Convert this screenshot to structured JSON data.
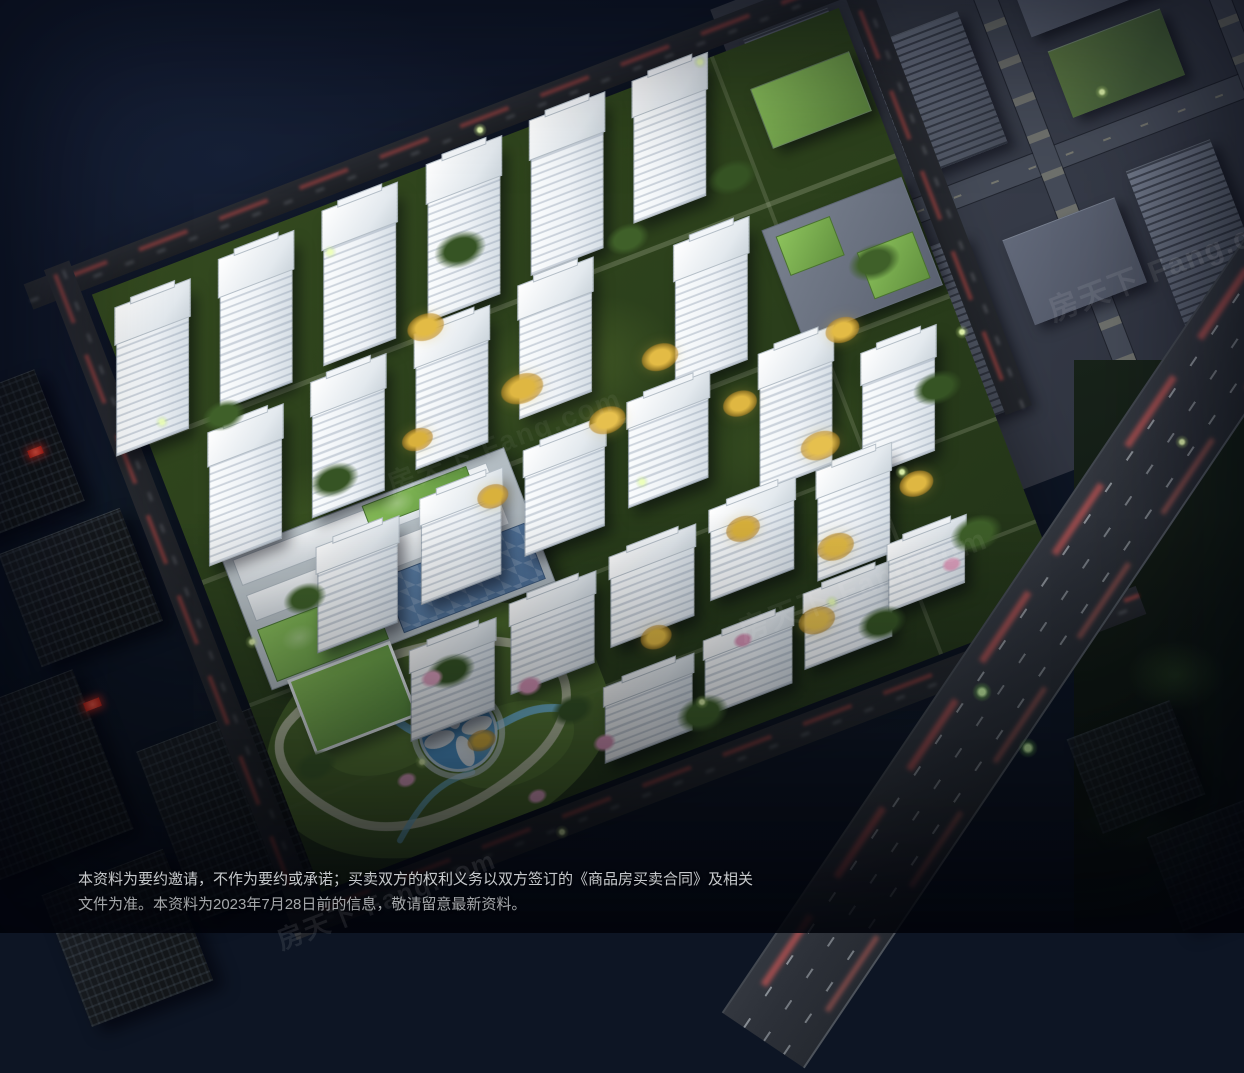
{
  "scene": {
    "description": "住宅小区整体鸟瞰夜景效果图（residential development aerial night rendering）",
    "elements": {
      "residential_towers": "white lit high-rise and mid-rise residential slabs in rows",
      "park": "central landscaped park with winding stream and circular plaza",
      "school": "school block with green roofs and blue playground",
      "commercial": "green-roof commercial podium blocks",
      "roads": "perimeter roads and elevated highway with red tail-light trails",
      "surroundings": "grey city blocks (top right), dark towers (bottom left), water (top left)"
    }
  },
  "colors": {
    "sky": "#0d1524",
    "water": "#10182a",
    "site-green": "#2a3e1b",
    "lawn": "#5d7c35",
    "road": "#26292e",
    "tower-face": "#eef2f6",
    "tree-yellow": "#e3bb45",
    "tree-green": "#3f6029",
    "tree-pink": "#e0a2c0",
    "stream-blue": "#74bede",
    "plaza-blue": "#4e96cc",
    "path-cream": "#cfd2ba",
    "red-trail": "#d73024",
    "city-block": "#5d6472",
    "roof-green": "#7fb457",
    "court-blue": "#5e82aa",
    "dark-building": "#17191d"
  },
  "disclaimer": {
    "line1": "本资料为要约邀请，不作为要约或承诺；买卖双方的权利义务以双方签订的《商品房买卖合同》及相关",
    "line2": "文件为准。本资料为2023年7月28日前的信息，敬请留意最新资料。"
  },
  "watermark": {
    "text": "房天下 Fang.com"
  }
}
